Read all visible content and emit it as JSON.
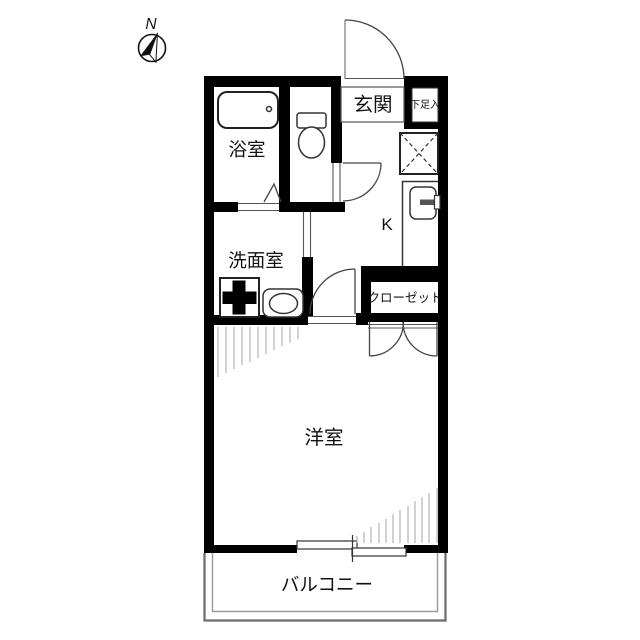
{
  "floorplan": {
    "compass": {
      "label": "N"
    },
    "labels": {
      "genkan": "玄関",
      "shoe_cabinet": "下足入",
      "bathroom": "浴室",
      "washroom": "洗面室",
      "kitchen": "K",
      "closet": "クローゼット",
      "western_room": "洋室",
      "balcony": "バルコニー"
    },
    "colors": {
      "wall": "#000000",
      "line": "#555555",
      "hatch": "#a6a6a6",
      "balcony": "#6b6b6b",
      "background": "#ffffff",
      "text": "#111111"
    }
  }
}
